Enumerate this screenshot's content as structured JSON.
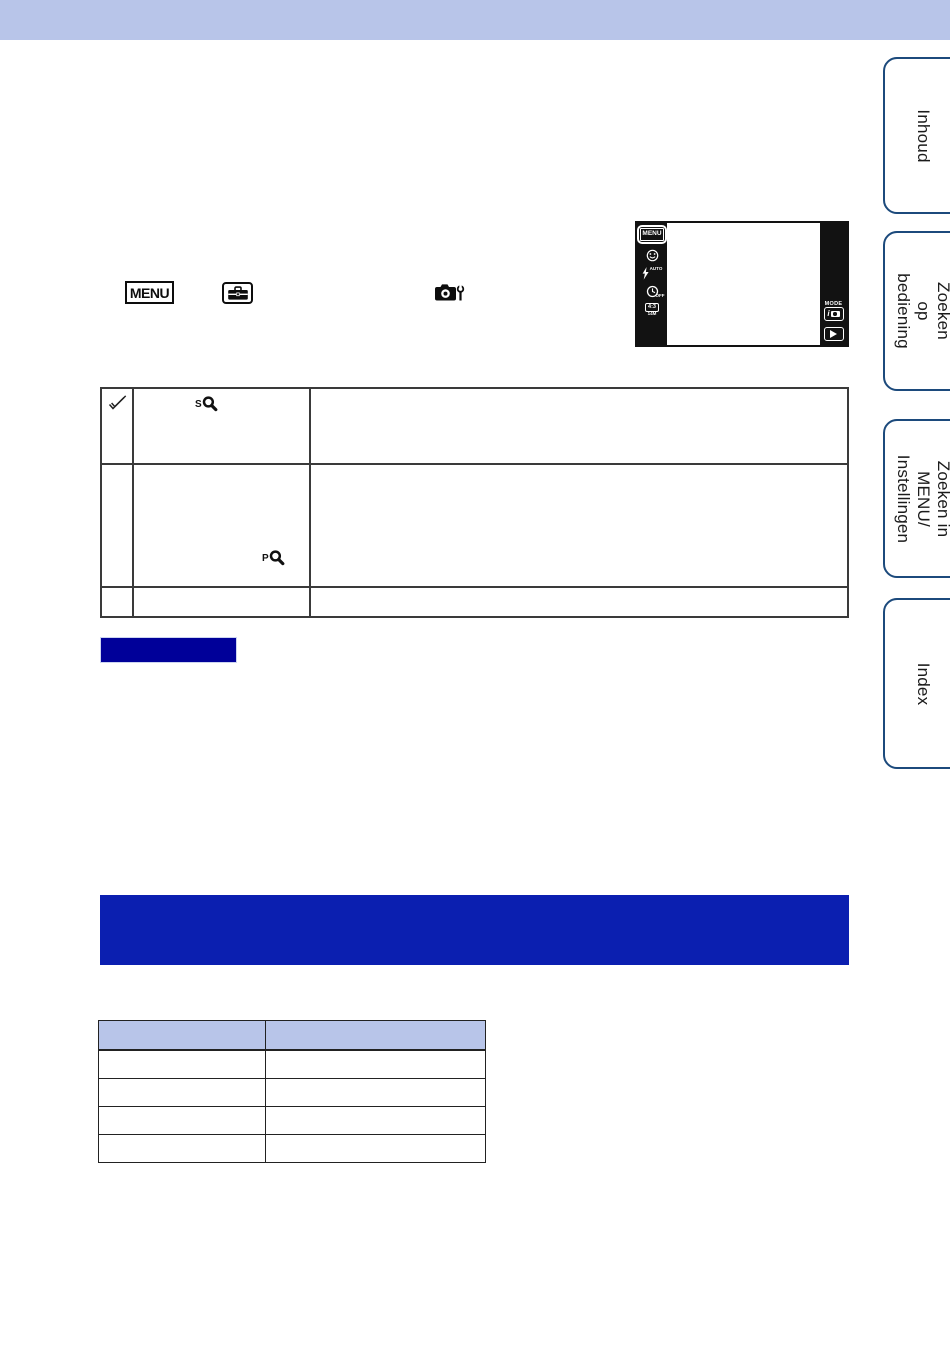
{
  "colors": {
    "topbar_bg": "#b8c5e9",
    "tab_border": "#1c4a7c",
    "notes_label_bg": "#000099",
    "banner_bg": "#0b1fb0",
    "table_header_bg": "#b8c5e9",
    "camera_strip_bg": "#121212"
  },
  "sidebar": {
    "tabs": [
      {
        "label": "Inhoud"
      },
      {
        "label": "Zoeken op\nbediening"
      },
      {
        "label": "Zoeken in MENU/\nInstellingen"
      },
      {
        "label": "Index"
      }
    ]
  },
  "inline_icons": {
    "menu_badge_label": "MENU"
  },
  "camera_screen": {
    "menu_button_label": "MENU",
    "flash_label": "AUTO",
    "timer_label": "OFF",
    "aspect_label": "4:3",
    "size_label": "14M",
    "mode_label": "MODE",
    "iauto_label": "i"
  },
  "zoom_table": {
    "rows": [
      {
        "has_default_check": true,
        "zoom_icon_prefix": "S"
      },
      {
        "has_default_check": false,
        "zoom_icon_prefix": "P"
      },
      {
        "has_default_check": false,
        "zoom_icon_prefix": ""
      }
    ]
  },
  "bottom_table": {
    "header_cells": [
      "",
      ""
    ],
    "body_rows": [
      [
        "",
        ""
      ],
      [
        "",
        ""
      ],
      [
        "",
        ""
      ],
      [
        "",
        ""
      ]
    ]
  }
}
